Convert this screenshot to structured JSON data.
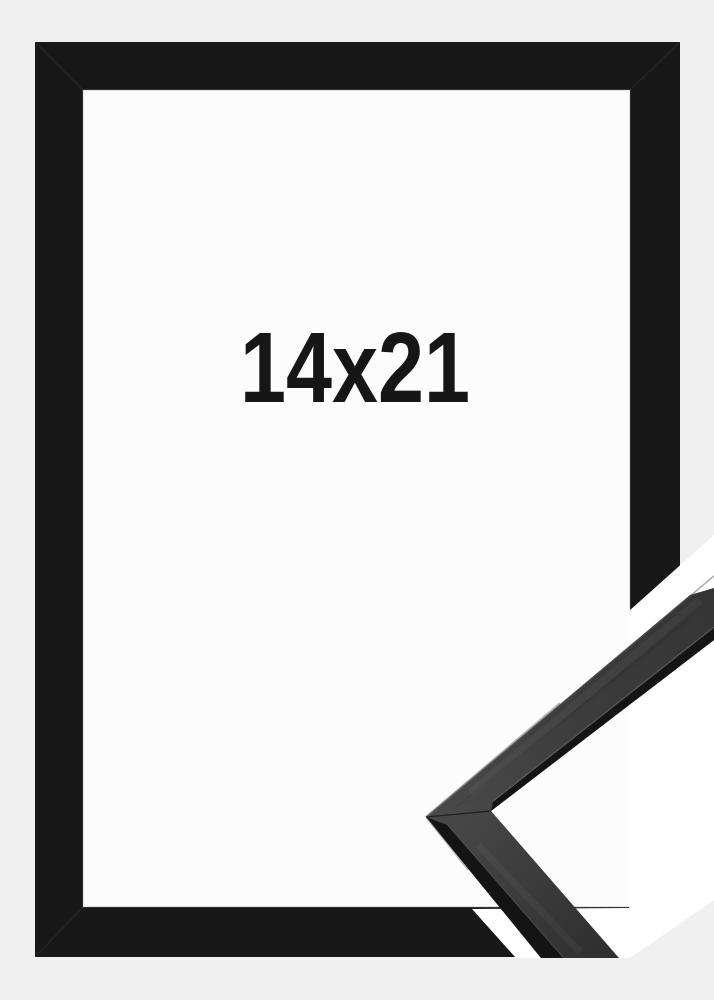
{
  "product_image": {
    "size_label": "14x21",
    "colors": {
      "background": "#f0f0f1",
      "frame": "#181818",
      "opening": "#fcfcfc",
      "cutout_band": "#ffffff",
      "label_text": "#161616",
      "profile_face": "#3d3d3d",
      "profile_edge": "#141414"
    }
  }
}
